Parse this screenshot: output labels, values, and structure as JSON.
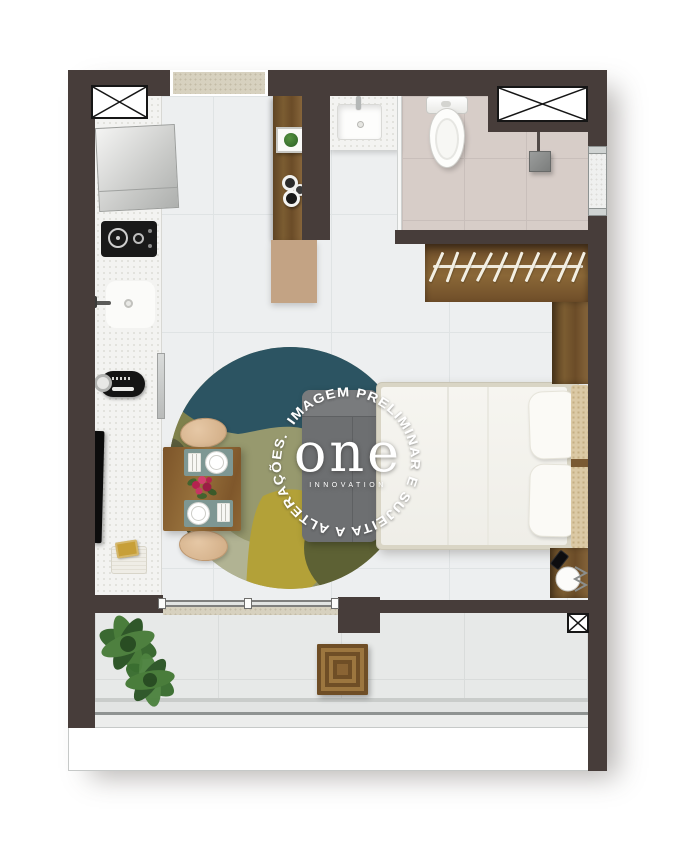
{
  "watermark": {
    "circular_text": "IMAGEM PRELIMINAR E SUJEITA A ALTERAÇÕES.",
    "logo": "one",
    "logo_sub": "INNOVATION",
    "text_color": "#ffffff"
  },
  "palette": {
    "background": "#ffffff",
    "wall": "#473d3a",
    "floor_main": "#edeff0",
    "floor_bathroom_wet": "#d7cdc8",
    "floor_balcony": "#e7e9e8",
    "counter_speckled": "#f3f3f1",
    "wood": "#7b5c31",
    "island_accent_tan": "#c3a384",
    "sofa_gray": "#6d6f71",
    "bed_linen": "#f4f3ee",
    "headboard_knit": "#dbc9a5",
    "chair_beige": "#d9b78f",
    "placemat_teal": "#7e9793",
    "rug_teal": "#2c5462",
    "rug_olive": "#7f814c",
    "rug_sage": "#8f9168",
    "rug_pale_sage": "#b1b393",
    "rug_mustard": "#b3a138",
    "rug_dark_olive": "#5d6134",
    "plant_green": "#3a6e30",
    "appliance_black": "#161616"
  },
  "fixtures": [
    "ventilation-shaft-x2",
    "entry-threshold",
    "refrigerator",
    "cooktop",
    "kitchen-sink",
    "microwave",
    "wall-tv",
    "storage-basket",
    "kitchen-island",
    "island-plant",
    "bowls",
    "bathroom-sink",
    "toilet",
    "shower-drain",
    "bathroom-window",
    "glass-partition",
    "wardrobe-with-hangers",
    "double-bed",
    "pillows",
    "headboard-cushion",
    "nightstand",
    "phone",
    "wire-side-table",
    "sofa",
    "round-rug",
    "dining-table",
    "dining-chairs",
    "place-settings",
    "flowers",
    "sliding-door",
    "balcony-plants",
    "wood-ottoman",
    "glass-railing",
    "balcony-shaft"
  ]
}
